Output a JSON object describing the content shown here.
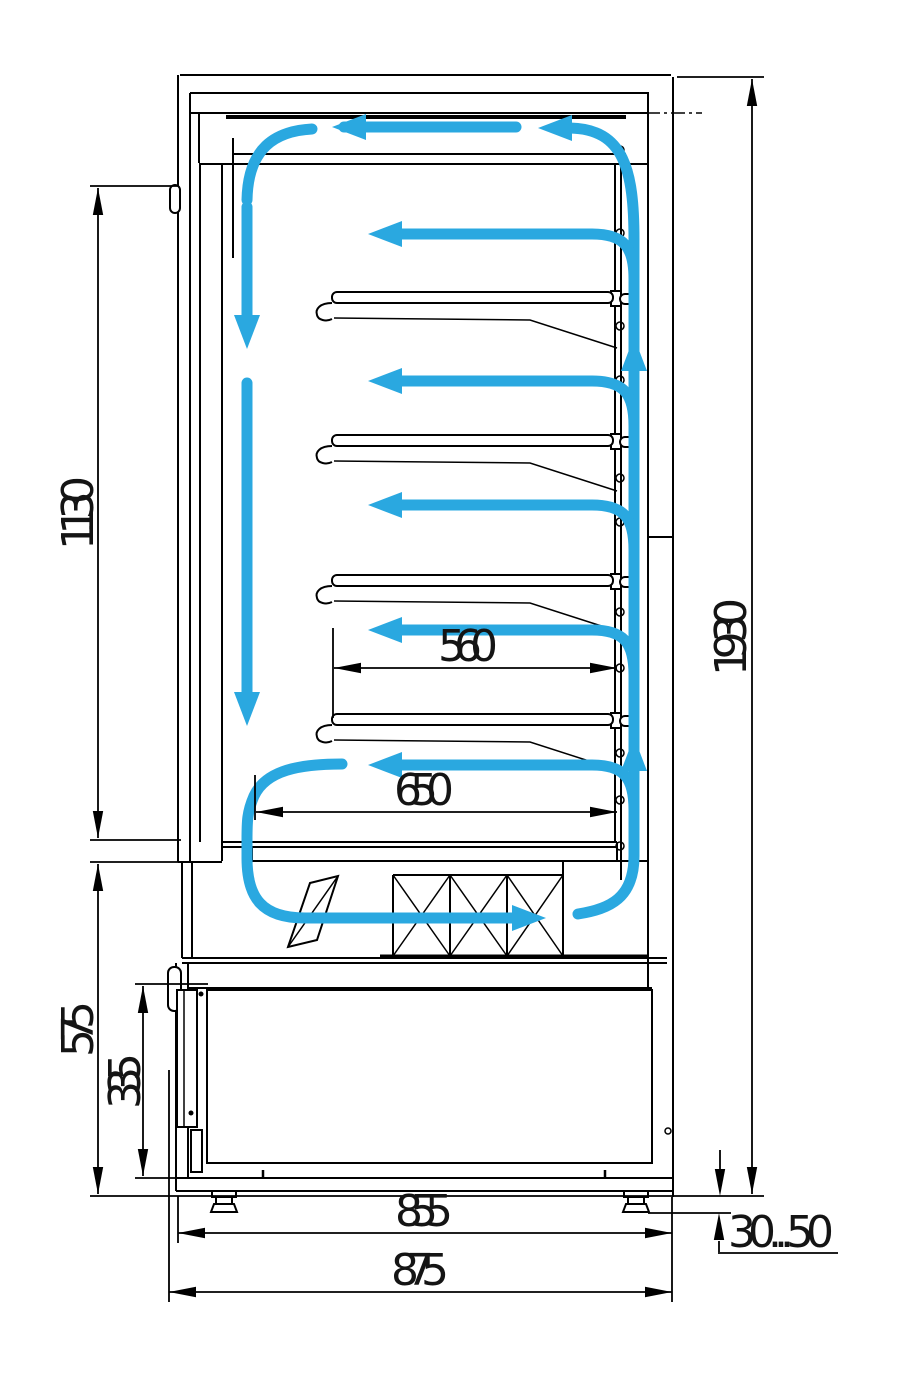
{
  "drawing": {
    "subject": "refrigerated display case side cross-section with air circulation arrows",
    "accent_color": "#2AA8E0",
    "line_color": "#000000",
    "dimension_labels": {
      "door_glass_height": "1130",
      "overall_height": "1930",
      "shelf_clearance_depth": "560",
      "lower_shelf_depth": "650",
      "base_section_height": "575",
      "machine_compartment_height": "335",
      "body_depth": "855",
      "overall_depth": "875",
      "leg_adjustment_range": "30...50"
    }
  }
}
